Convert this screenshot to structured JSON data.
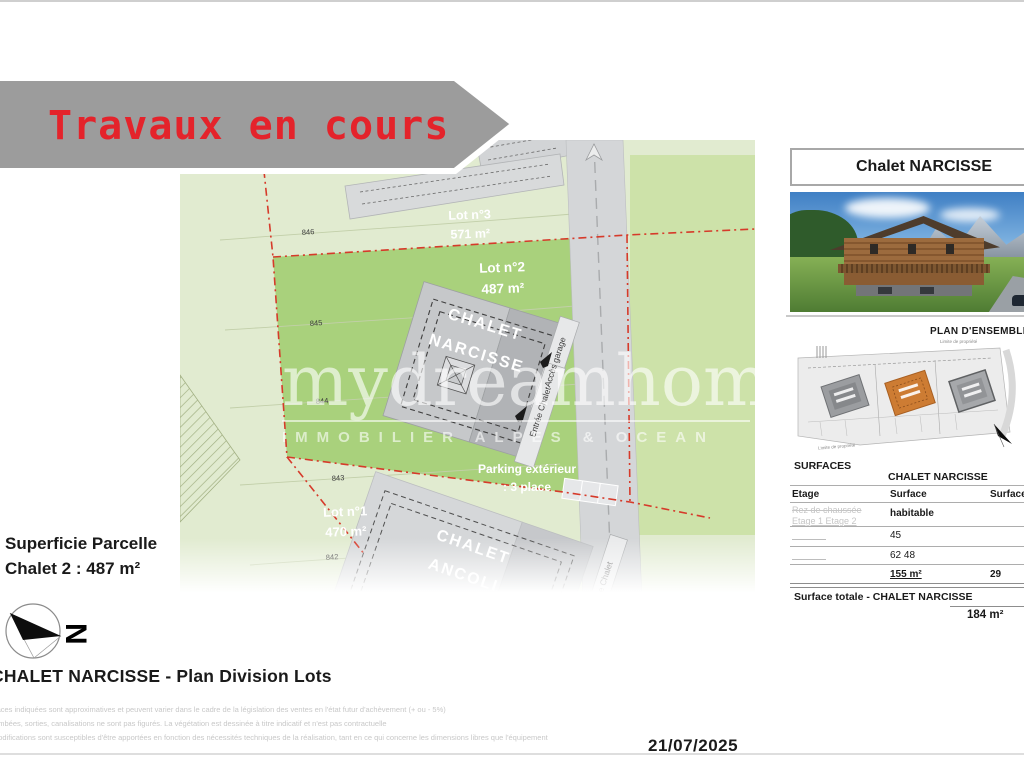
{
  "page": {
    "banner_label": "Travaux en cours",
    "date": "21/07/2025",
    "plan_caption": "CHALET NARCISSE - Plan Division Lots",
    "superficie_line1": "Superficie Parcelle",
    "superficie_line2": "Chalet 2 : 487 m²",
    "compass_letter": "N",
    "disclaimers": [
      "rfaces indiquées sont approximatives et peuvent varier dans le cadre de la législation des ventes en l'état futur d'achèvement (+ ou - 5%)",
      "tombées, sorties, canalisations ne sont pas figurés. La végétation est dessinée à titre indicatif et n'est pas contractuelle",
      "modifications sont susceptibles d'être apportées en fonction des nécessités techniques de la réalisation, tant en ce qui concerne les dimensions libres que l'équipement"
    ]
  },
  "site_plan": {
    "street_label": "té",
    "contours": [
      "846",
      "845",
      "844",
      "843",
      "842"
    ],
    "lots": [
      {
        "name": "Lot n°3",
        "area": "571 m²"
      },
      {
        "name": "Lot n°2",
        "area": "487 m²"
      },
      {
        "name": "Lot n°1",
        "area": "470 m²"
      }
    ],
    "chalet_narcisse_line1": "CHALET",
    "chalet_narcisse_line2": "NARCISSE",
    "chalet_ancoli_line1": "CHALET",
    "chalet_ancoli_line2": "ANCOLI",
    "parking_line1": "Parking extérieur",
    "parking_line2": ": 3 place",
    "acces_garage": "Accès garage",
    "entree_chalet": "Entrée Chalet",
    "entree_chalet_ancoli": "e Chalet"
  },
  "watermark": {
    "brand": "mydreamhome",
    "tagline": "IMMOBILIER ALPES & OCEAN"
  },
  "right_panel": {
    "title": "Chalet NARCISSE",
    "plan_ensemble_title": "PLAN D'ENSEMBLE",
    "limite_propriete": "Limite de propriété",
    "surfaces": {
      "heading": "SURFACES",
      "subject": "CHALET NARCISSE",
      "col_etage": "Etage",
      "col_surface": "Surface",
      "col_surface_right": "Surface",
      "etage_placeholder1": "Rez de chaussée",
      "etage_placeholder2": "Etage 1 Etage 2",
      "surface_habitable": "habitable",
      "row_values": [
        "45",
        "62 48"
      ],
      "total_surface": "155 m²",
      "total_surface_right": "29",
      "total_label": "Surface totale - CHALET NARCISSE",
      "grand_total": "184 m²"
    }
  },
  "colors": {
    "banner_gray": "#9c9c9c",
    "alert_red": "#e4232b",
    "boundary_red": "#d63a2a",
    "lot_green_dark": "#a9d17c",
    "lot_green_light": "#e1ebd0",
    "road_gray": "#d4d6d8",
    "highlight_orange": "#cd7c33"
  }
}
